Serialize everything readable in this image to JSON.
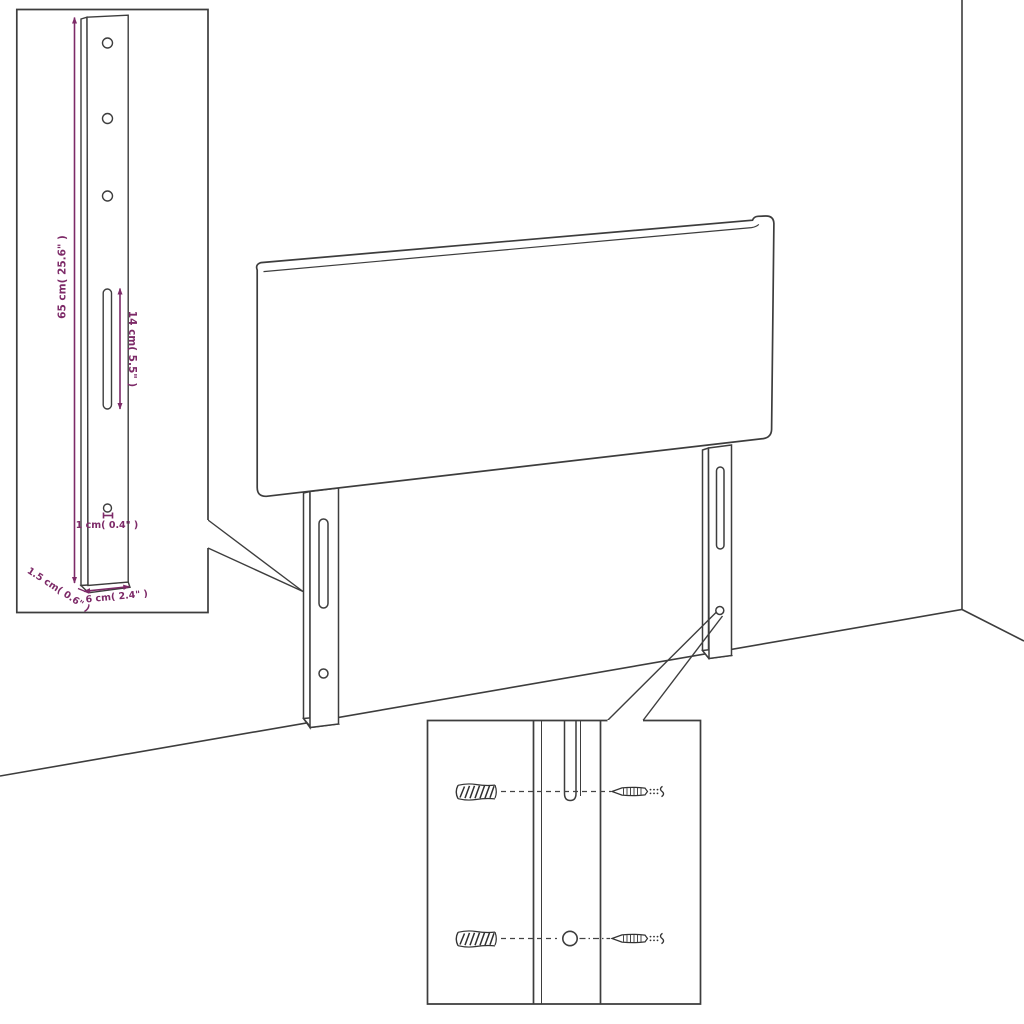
{
  "diagram": {
    "title_visible_text": "",
    "labels": {
      "bracket_height": "65 cm( 25.6\" )",
      "slot_length": "14 cm( 5.5\" )",
      "hole_size": "1 cm( 0.4\" )",
      "bracket_thickness": "1.5 cm( 0.6\" )",
      "bracket_width": "6 cm( 2.4\" )"
    },
    "colors": {
      "line": "#3d3d3d",
      "dimension": "#7d2a68",
      "background": "#ffffff"
    },
    "icons": {
      "wall_plug": "hatched-cylinder-shape",
      "screw": "pointed-screw-shape",
      "mounting_hole": "circle-outline",
      "mounting_slot": "rounded-slot-outline"
    }
  }
}
